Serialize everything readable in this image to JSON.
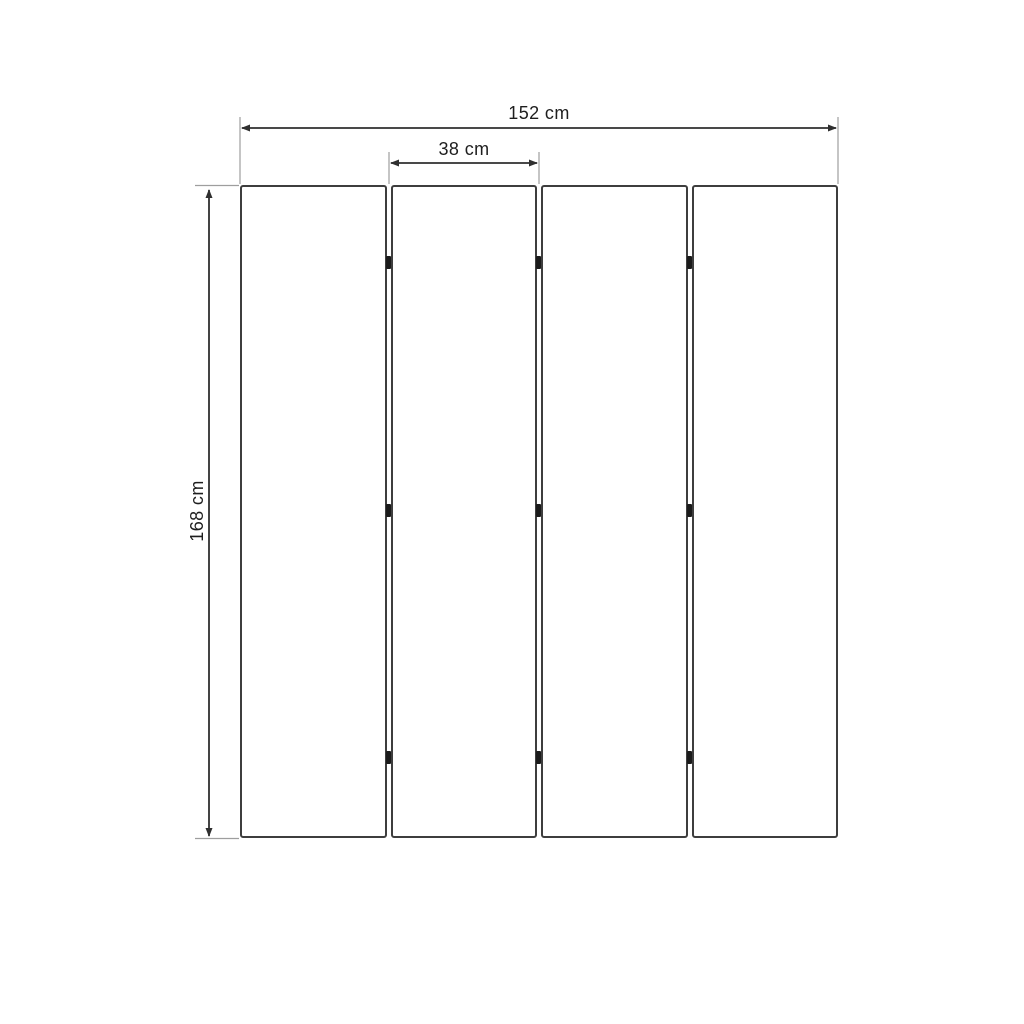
{
  "diagram": {
    "type": "dimension-drawing",
    "panel_count": 4,
    "hinge_rows": 3,
    "dimensions": {
      "total_width": {
        "label": "152 cm",
        "value_cm": 152
      },
      "panel_width": {
        "label": "38 cm",
        "value_cm": 38
      },
      "height": {
        "label": "168 cm",
        "value_cm": 168
      }
    },
    "colors": {
      "background": "#ffffff",
      "panel_outline": "#3e3e3e",
      "dimension_line": "#2f2f2f",
      "extension_line": "#9e9e9e",
      "hinge": "#1b1b1b",
      "label_text": "#1e1e1e"
    }
  }
}
